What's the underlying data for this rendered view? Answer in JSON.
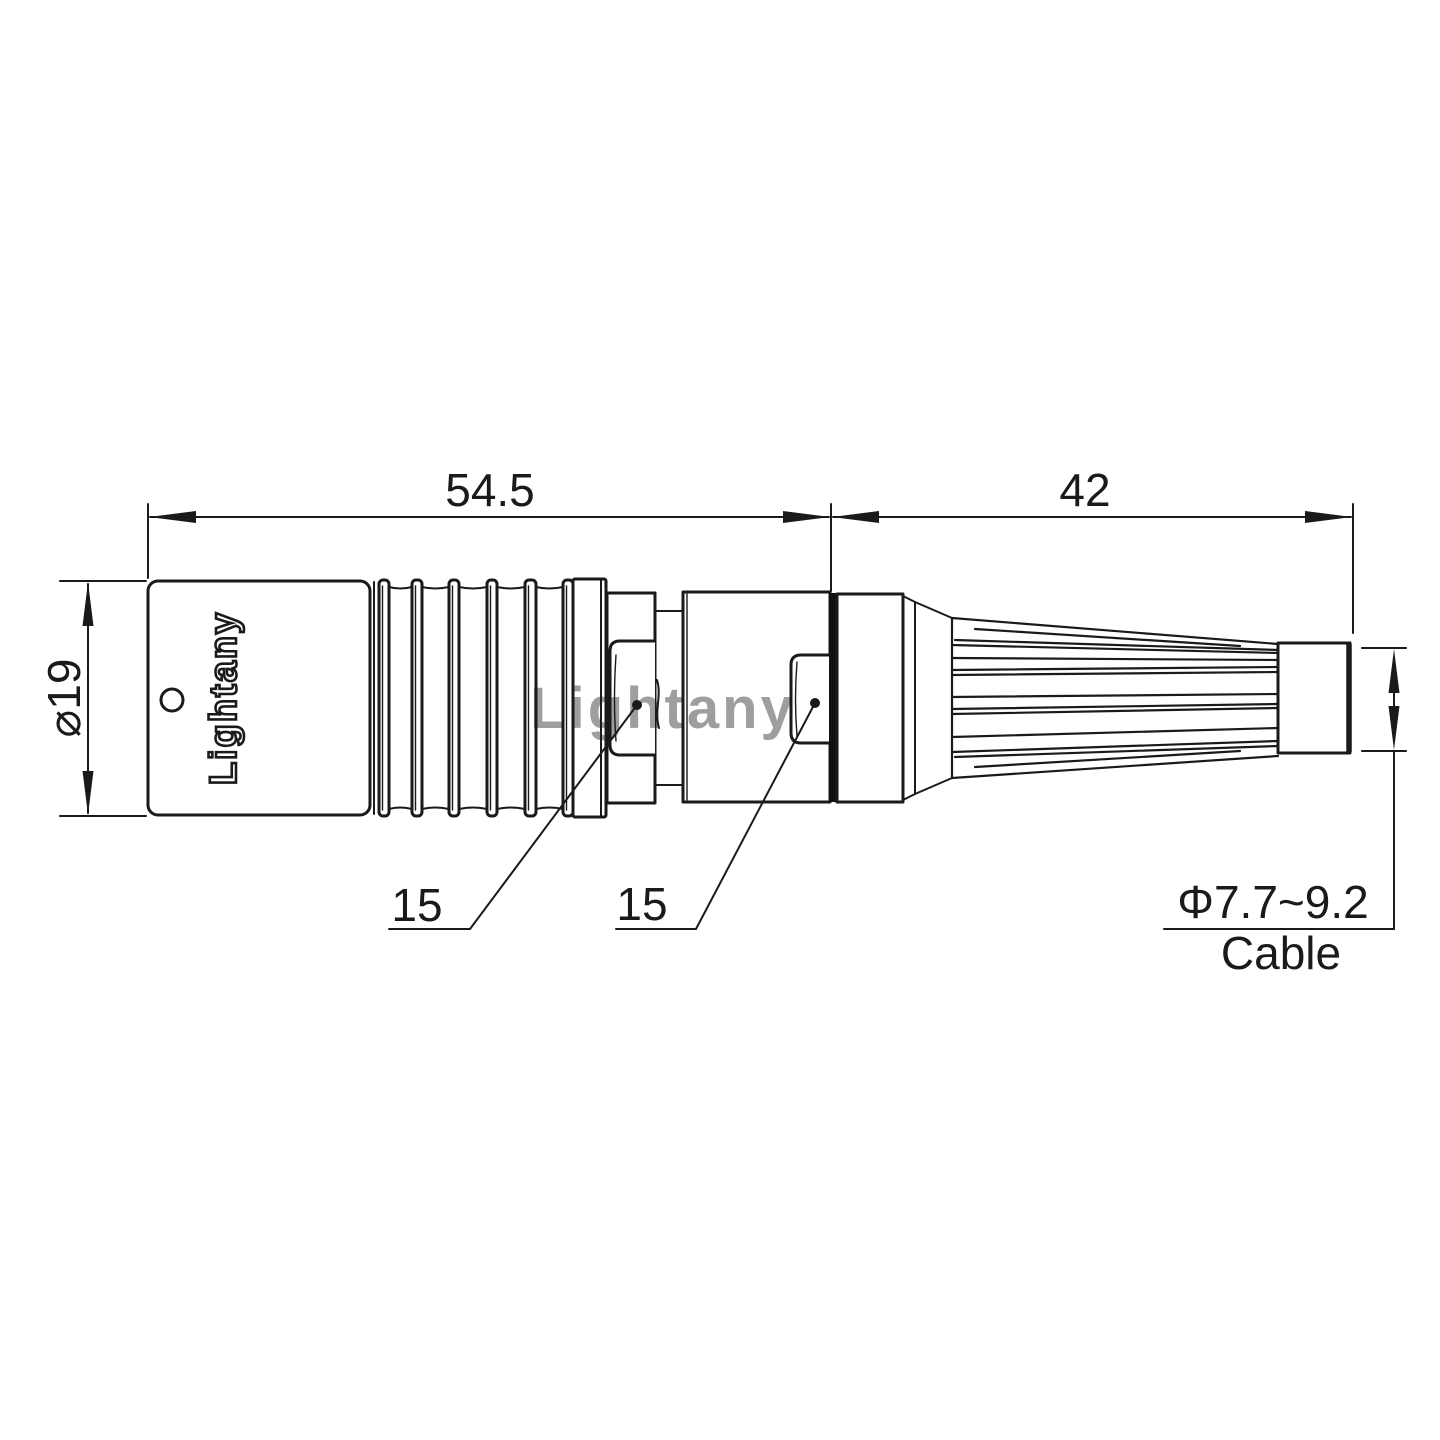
{
  "dimensions": {
    "front_length": "54.5",
    "back_length": "42",
    "body_diameter": "⌀19",
    "front_note": "15",
    "back_note": "15",
    "cable_range": "Φ7.7~9.2",
    "cable_label": "Cable"
  },
  "brand": {
    "engraving": "Lightany"
  },
  "watermark": {
    "text": "Lightany",
    "color": "#e98f8f"
  },
  "colors": {
    "line": "#1a1a1a",
    "background": "#ffffff"
  }
}
